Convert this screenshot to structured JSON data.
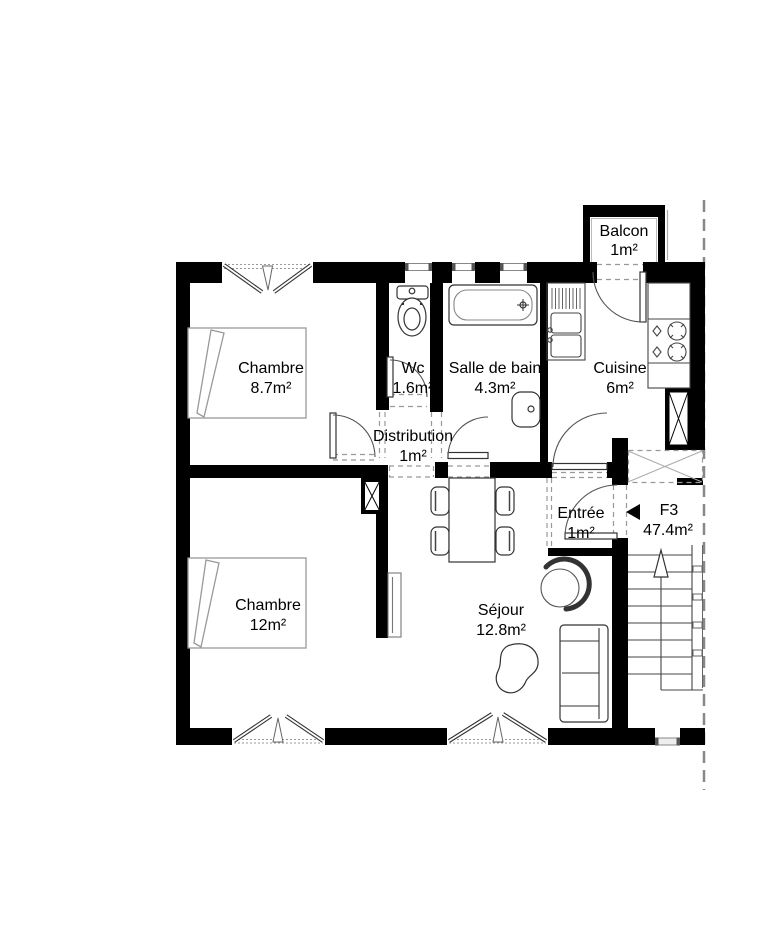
{
  "unit": {
    "label": "F3",
    "area": "47.4m²"
  },
  "rooms": [
    {
      "id": "chambre-1",
      "name": "Chambre",
      "area": "8.7m²"
    },
    {
      "id": "wc",
      "name": "Wc",
      "area": "1.6m²"
    },
    {
      "id": "salle-de-bain",
      "name": "Salle de bain",
      "area": "4.3m²"
    },
    {
      "id": "cuisine",
      "name": "Cuisine",
      "area": "6m²"
    },
    {
      "id": "balcon",
      "name": "Balcon",
      "area": "1m²"
    },
    {
      "id": "distribution",
      "name": "Distribution",
      "area": "1m²"
    },
    {
      "id": "entree",
      "name": "Entrée",
      "area": "1m²"
    },
    {
      "id": "chambre-2",
      "name": "Chambre",
      "area": "12m²"
    },
    {
      "id": "sejour",
      "name": "Séjour",
      "area": "12.8m²"
    }
  ],
  "colors": {
    "wall": "#000000",
    "fixture_line": "#333333",
    "light_line": "#999999",
    "background": "#ffffff"
  }
}
